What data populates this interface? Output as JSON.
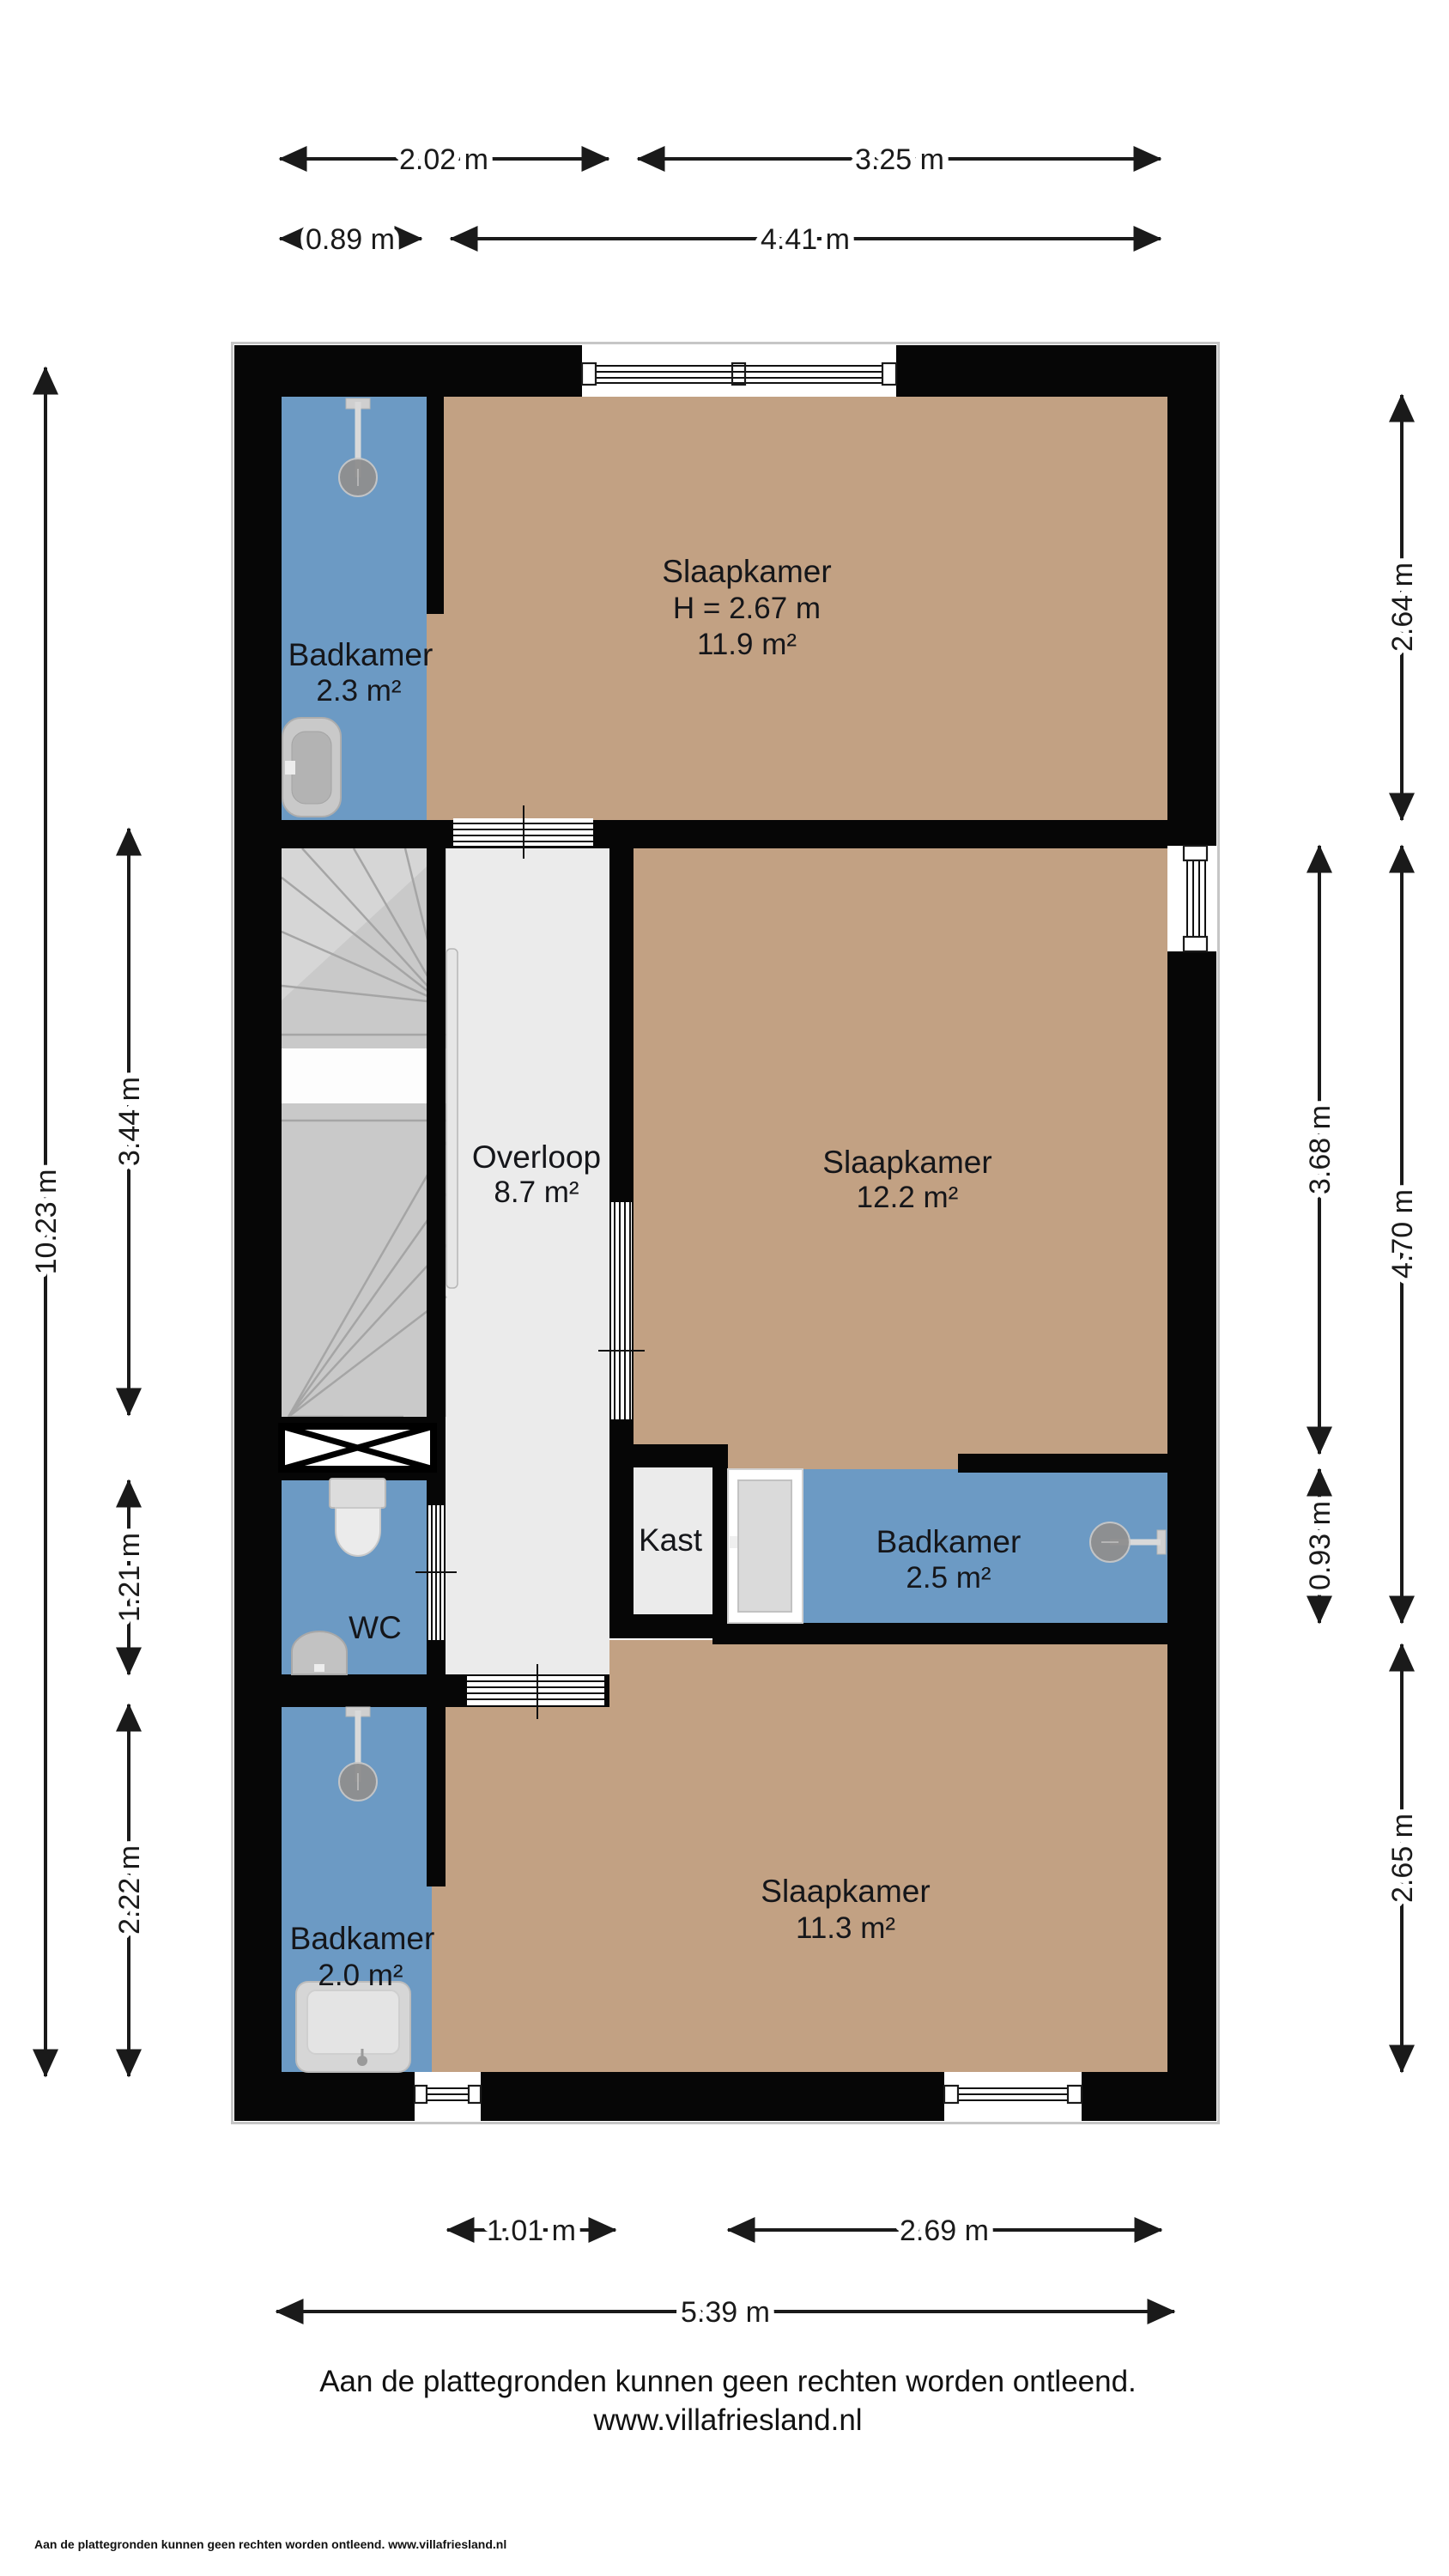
{
  "colors": {
    "wall": "#060606",
    "floor_bedroom": "#c2a183",
    "floor_wet_room": "#6c9ac4",
    "floor_hallway": "#ebebeb",
    "stairs": "#c9c9c9",
    "dimension_text": "#1a1a1a"
  },
  "rooms": {
    "slaapkamer_top": {
      "name": "Slaapkamer",
      "ceiling_height": "H = 2.67 m",
      "area": "11.9 m²"
    },
    "badkamer_top": {
      "name": "Badkamer",
      "area": "2.3 m²"
    },
    "overloop": {
      "name": "Overloop",
      "area": "8.7 m²"
    },
    "slaapkamer_mid": {
      "name": "Slaapkamer",
      "area": "12.2 m²"
    },
    "wc": {
      "name": "WC"
    },
    "kast": {
      "name": "Kast"
    },
    "badkamer_mid": {
      "name": "Badkamer",
      "area": "2.5 m²"
    },
    "badkamer_bottom": {
      "name": "Badkamer",
      "area": "2.0 m²"
    },
    "slaapkamer_bottom": {
      "name": "Slaapkamer",
      "area": "11.3 m²"
    }
  },
  "dimensions": {
    "top_inner_left": "2.02 m",
    "top_inner_right": "3.25 m",
    "top_outer_left": "0.89 m",
    "top_outer_right": "4.41 m",
    "bottom_inner_left": "1.01 m",
    "bottom_inner_right": "2.69 m",
    "bottom_outer": "5.39 m",
    "left_total": "10.23 m",
    "left_stairs": "3.44 m",
    "left_wc": "1.21 m",
    "left_badkamer": "2.22 m",
    "right_top": "2.64 m",
    "right_mid_inner": "3.68 m",
    "right_mid_outer": "4.70 m",
    "right_badkamer": "0.93 m",
    "right_bottom": "2.65 m"
  },
  "footer": {
    "disclaimer": "Aan de plattegronden kunnen geen rechten worden ontleend.",
    "website": "www.villafriesland.nl",
    "small_print": "Aan de plattegronden kunnen geen rechten worden ontleend. www.villafriesland.nl"
  }
}
